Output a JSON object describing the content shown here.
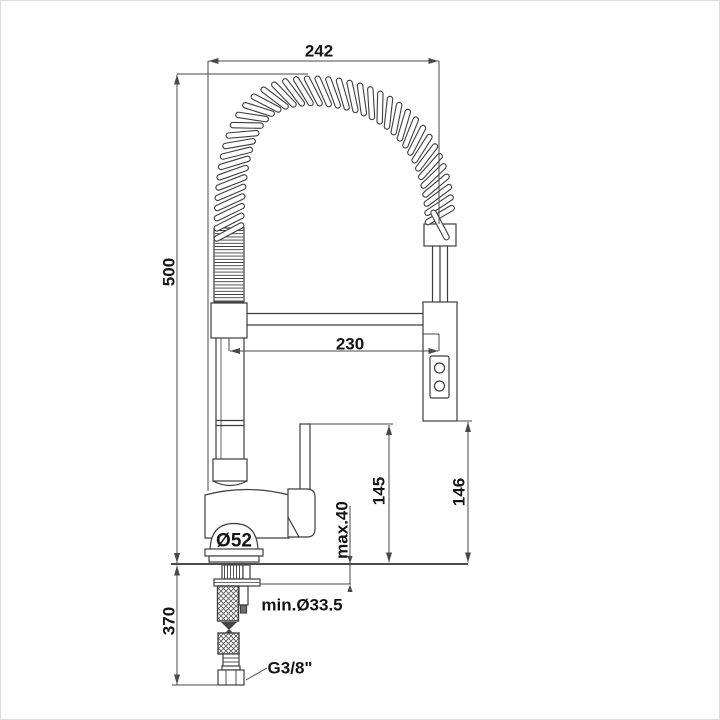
{
  "drawing_title": "kitchen faucet with spring spout - dimensional drawing",
  "colors": {
    "background": "#ffffff",
    "line": "#3e3e3e",
    "dimension_line": "#4a4a4a",
    "text": "#141414"
  },
  "labels": {
    "spout_width": "242",
    "overall_height": "500",
    "arm_reach": "230",
    "handle_height": "145",
    "spray_head_height": "146",
    "deck_thickness": "max.40",
    "base_diameter": "Ø52",
    "mounting_hole": "min.Ø33.5",
    "hose_drop": "370",
    "thread_size": "G3/8\""
  }
}
